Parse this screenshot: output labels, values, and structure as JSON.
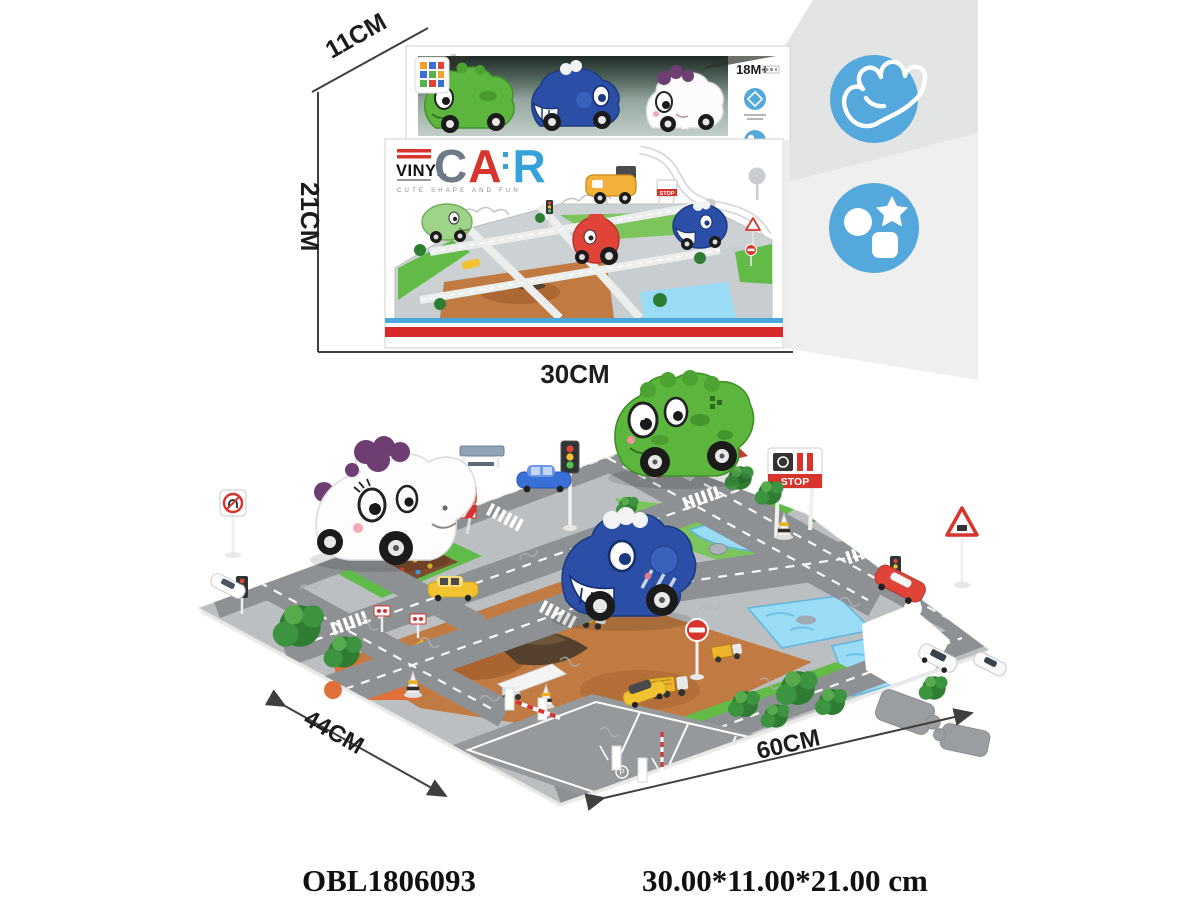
{
  "product": {
    "code": "OBL1806093",
    "dimensions_text": "30.00*11.00*21.00 cm"
  },
  "annotations": {
    "box_depth": "11CM",
    "box_height": "21CM",
    "box_width": "30CM",
    "mat_depth": "44CM",
    "mat_width": "60CM"
  },
  "box": {
    "age_grade": "18M+",
    "brand": "VINYL",
    "title_letters": {
      "c": "C",
      "a": "A",
      "r": "R"
    },
    "tagline": "CUTE SHAPE AND FUN",
    "art": {
      "stop": "STOP"
    }
  },
  "mat": {
    "stop": "STOP",
    "caution": "CAUTION",
    "parking_label": "P"
  },
  "feature_icons": [
    {
      "name": "grab-hand-icon"
    },
    {
      "name": "shapes-icon"
    }
  ],
  "colors": {
    "feature_blue": "#54a8dc",
    "red": "#d6342c",
    "letter_gray": "#6d7a87",
    "letter_blue": "#35a3da",
    "mat_green": "#5fbb4a",
    "construction_tan": "#c07a42",
    "water_blue": "#9adbf5"
  }
}
